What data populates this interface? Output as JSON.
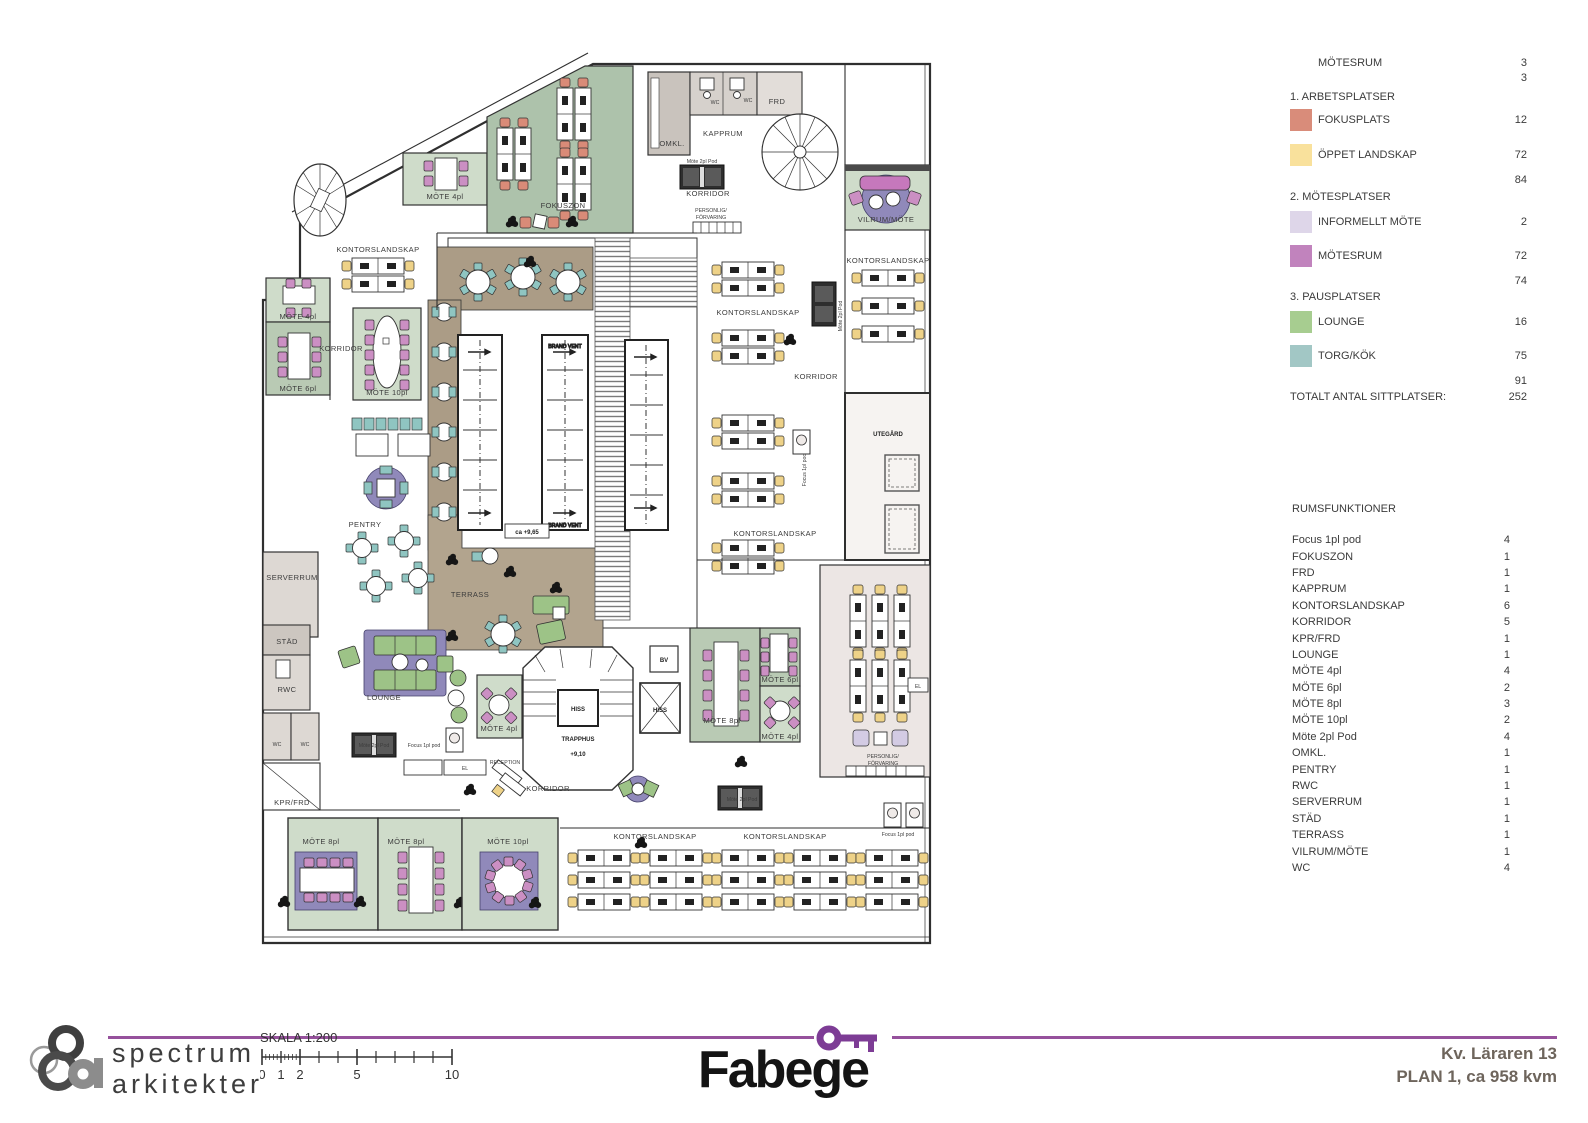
{
  "legend": {
    "partial": {
      "label": "MÖTESRUM",
      "value": "3",
      "subtotal": "3"
    },
    "sections": [
      {
        "title": "1. ARBETSPLATSER",
        "items": [
          {
            "label": "FOKUSPLATS",
            "value": "12",
            "color": "#d98c7a"
          },
          {
            "label": "ÖPPET LANDSKAP",
            "value": "72",
            "color": "#f9e19c"
          }
        ],
        "subtotal": "84"
      },
      {
        "title": "2. MÖTESPLATSER",
        "items": [
          {
            "label": "INFORMELLT MÖTE",
            "value": "2",
            "color": "#ded6e9"
          },
          {
            "label": "MÖTESRUM",
            "value": "72",
            "color": "#c183bd"
          }
        ],
        "subtotal": "74"
      },
      {
        "title": "3. PAUSPLATSER",
        "items": [
          {
            "label": "LOUNGE",
            "value": "16",
            "color": "#a7cd90"
          },
          {
            "label": "TORG/KÖK",
            "value": "75",
            "color": "#a2c7c5"
          }
        ],
        "subtotal": "91"
      }
    ],
    "total_label": "TOTALT ANTAL SITTPLATSER:",
    "total_value": "252"
  },
  "room_functions": {
    "title": "RUMSFUNKTIONER",
    "items": [
      [
        "Focus 1pl pod",
        "4"
      ],
      [
        "FOKUSZON",
        "1"
      ],
      [
        "FRD",
        "1"
      ],
      [
        "KAPPRUM",
        "1"
      ],
      [
        "KONTORSLANDSKAP",
        "6"
      ],
      [
        "KORRIDOR",
        "5"
      ],
      [
        "KPR/FRD",
        "1"
      ],
      [
        "LOUNGE",
        "1"
      ],
      [
        "MÖTE 4pl",
        "4"
      ],
      [
        "MÖTE 6pl",
        "2"
      ],
      [
        "MÖTE 8pl",
        "3"
      ],
      [
        "MÖTE 10pl",
        "2"
      ],
      [
        "Möte 2pl Pod",
        "4"
      ],
      [
        "OMKL.",
        "1"
      ],
      [
        "PENTRY",
        "1"
      ],
      [
        "RWC",
        "1"
      ],
      [
        "SERVERRUM",
        "1"
      ],
      [
        "STÄD",
        "1"
      ],
      [
        "TERRASS",
        "1"
      ],
      [
        "VILRUM/MÖTE",
        "1"
      ],
      [
        "WC",
        "4"
      ]
    ]
  },
  "plan": {
    "labels": {
      "kontorslandskap": "KONTORSLANDSKAP",
      "korridor": "KORRIDOR",
      "fokuszon": "FOKUSZON",
      "mote4": "MÖTE 4pl",
      "mote6": "MÖTE 6pl",
      "mote8": "MÖTE 8pl",
      "mote10": "MÖTE 10pl",
      "pentry": "PENTRY",
      "serverrum": "SERVERRUM",
      "stad": "STÄD",
      "rwc": "RWC",
      "wc": "WC",
      "kprfrd": "KPR/FRD",
      "lounge": "LOUNGE",
      "terrass": "TERRASS",
      "utegard": "UTEGÅRD",
      "trapphus": "TRAPPHUS",
      "hiss": "HISS",
      "bv": "BV",
      "el": "EL",
      "reception": "RECEPTION",
      "personlig": "PERSONLIG/",
      "forvaring": "FÖRVARING",
      "brandvent": "BRAND VENT",
      "vilrum": "VILRUM/MÖTE",
      "omkl": "OMKL.",
      "kapprum": "KAPPRUM",
      "frd": "FRD",
      "mote2pod": "Möte 2pl Pod",
      "focuspod": "Focus 1pl pod",
      "level_trapphus": "+9,10",
      "level_floor": "ca +9,65"
    }
  },
  "footer": {
    "firm_line1": "spectrum",
    "firm_line2": "arkitekter",
    "scale_label": "SKALA 1:200",
    "scale_ticks": [
      "0",
      "1",
      "2",
      "5",
      "10"
    ],
    "brand": "Fabege",
    "brand_purple": "#7d3c95",
    "line_purple": "#96519c",
    "project_line1": "Kv. Läraren 13",
    "project_line2": "PLAN 1, ca 958 kvm"
  }
}
